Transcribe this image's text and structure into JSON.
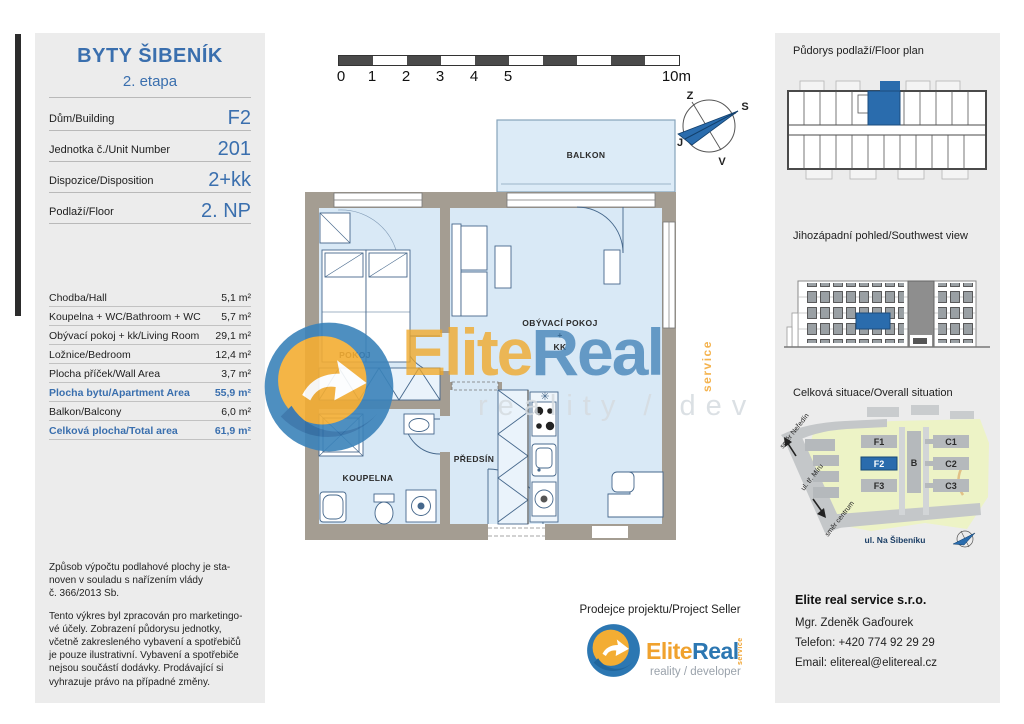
{
  "accent_blue": "#3a6fae",
  "left_panel": {
    "title": "BYTY ŠIBENÍK",
    "subtitle": "2. etapa",
    "info_rows": [
      {
        "label": "Dům/Building",
        "value": "F2"
      },
      {
        "label": "Jednotka č./Unit Number",
        "value": "201"
      },
      {
        "label": "Dispozice/Disposition",
        "value": "2+kk"
      },
      {
        "label": "Podlaží/Floor",
        "value": "2. NP"
      }
    ],
    "area_rows": [
      {
        "label": "Chodba/Hall",
        "value": "5,1 m²",
        "highlight": false
      },
      {
        "label": "Koupelna + WC/Bathroom + WC",
        "value": "5,7 m²",
        "highlight": false
      },
      {
        "label": "Obývací pokoj + kk/Living Room",
        "value": "29,1 m²",
        "highlight": false
      },
      {
        "label": "Ložnice/Bedroom",
        "value": "12,4 m²",
        "highlight": false
      },
      {
        "label": "Plocha příček/Wall Area",
        "value": "3,7 m²",
        "highlight": false
      },
      {
        "label": "Plocha bytu/Apartment Area",
        "value": "55,9 m²",
        "highlight": true
      },
      {
        "label": "Balkon/Balcony",
        "value": "6,0 m²",
        "highlight": false
      },
      {
        "label": "Celková plocha/Total area",
        "value": "61,9 m²",
        "highlight": true
      }
    ],
    "legal": [
      "Způsob výpočtu podlahové plochy je sta-\nnoven v souladu s nařízením vlády\nč. 366/2013 Sb.",
      "Tento výkres byl zpracován pro marketingo-\nvé účely. Zobrazení půdorysu jednotky,\nvčetně zakresleného vybavení a spotřebičů\nje pouze ilustrativní. Vybavení a spotřebiče\nnejsou součástí dodávky. Prodávající si\nvyhrazuje právo na případné změny."
    ]
  },
  "scale_bar": {
    "ticks": [
      "0",
      "1",
      "2",
      "3",
      "4",
      "5"
    ],
    "end": "10m"
  },
  "compass": {
    "top": "Z",
    "right": "S",
    "bottom": "V",
    "left": "J"
  },
  "floor_plan": {
    "labels": {
      "balcony": "BALKON",
      "bedroom": "POKOJ",
      "living_1": "OBÝVACÍ POKOJ",
      "living_2": "+",
      "living_3": "KK",
      "bathroom": "KOUPELNA",
      "hall": "PŘEDSÍN",
      "kitchen_mark": "✳"
    }
  },
  "watermark": {
    "brand_a": "Elite",
    "brand_b": "Real",
    "vertical": "service",
    "tagline": "reality / dev"
  },
  "seller": {
    "heading": "Prodejce projektu/Project Seller",
    "brand_a": "Elite",
    "brand_b": "Real",
    "vertical": "service",
    "tagline": "reality / developer"
  },
  "right_panel": {
    "floorplan_heading": "Půdorys podlaží/Floor plan",
    "elevation_heading": "Jihozápadní pohled/Southwest view",
    "situation_heading": "Celková situace/Overall situation",
    "site_map": {
      "f1": "F1",
      "f2": "F2",
      "f3": "F3",
      "b": "B",
      "c1": "C1",
      "c2": "C2",
      "c3": "C3",
      "street": "ul. Na Šibeníku",
      "dir_top": "směr Neředín",
      "road": "ul. tř. Míru",
      "dir_bottom": "směr centrum"
    },
    "contact": {
      "company": "Elite real service s.r.o.",
      "person": "Mgr. Zdeněk Gaďourek",
      "phone": "Telefon: +420 774 92 29 29",
      "email": "Email: elitereal@elitereal.cz"
    }
  }
}
